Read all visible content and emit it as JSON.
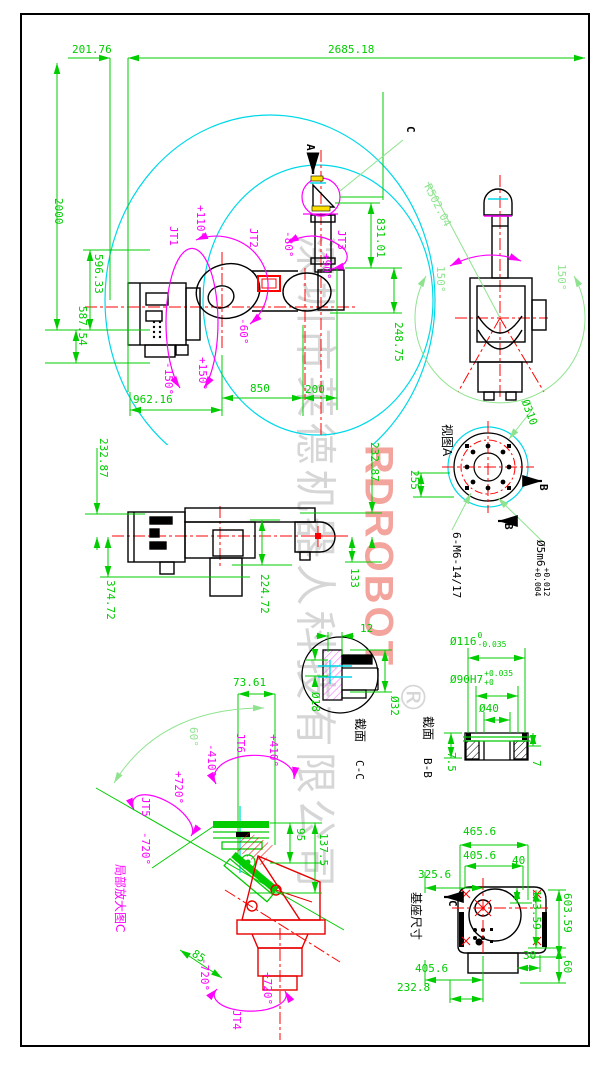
{
  "watermark": {
    "company": "深圳市莱德机器人科技有限公司",
    "brand": "RDROBOT",
    "registered": "®"
  },
  "main_view": {
    "dims": {
      "d201": "201.76",
      "d2685": "2685.18",
      "d2000": "2000",
      "d596": "596.33",
      "d587": "587.54",
      "d962": "962.16",
      "d850": "850",
      "d200": "200",
      "d831": "831.01",
      "d248": "248.75"
    },
    "joints": {
      "jt1": {
        "label": "JT1",
        "min": "-150°",
        "max": "+150°"
      },
      "jt2": {
        "label": "JT2",
        "max": "+110°",
        "min": "-60°"
      },
      "jt3": {
        "label": "JT3",
        "min": "-80°",
        "max": "+90°"
      }
    },
    "view_arrow": "A",
    "detail_mark": "C"
  },
  "top_view": {
    "radius": "R502.04",
    "angle_left": "150°",
    "angle_right": "150°"
  },
  "view_a": {
    "title": "视图A",
    "dia": "Ø310",
    "d255": "255",
    "section_mark": "B",
    "note_bolts": "6-M6-14/17",
    "note_pin": "Ø5m6",
    "pin_tol_top": "+0.012",
    "pin_tol_bot": "+0.004"
  },
  "folded_view": {
    "d232l": "232.87",
    "d232r": "232.87",
    "d374": "374.72",
    "d224": "224.72",
    "d133": "133"
  },
  "section_cc": {
    "title": "截面",
    "name": "C-C",
    "d12": "12",
    "d18": "Ø18",
    "d32": "Ø32"
  },
  "section_bb": {
    "title": "截面",
    "name": "B-B",
    "d116": "Ø116",
    "d116_tol_top": "0",
    "d116_tol_bot": "-0.035",
    "d90": "Ø90H7",
    "d90_tol_top": "+0.035",
    "d90_tol_bot": "+0",
    "d40": "Ø40",
    "d75": "7.5",
    "d7": "7"
  },
  "detail_view": {
    "label": "局部放大图C",
    "d7361": "73.61",
    "d95": "95",
    "d1375": "137.5",
    "d85": "85",
    "d60": "60°",
    "jt4": {
      "label": "JT4",
      "min": "-720°",
      "max": "+720°"
    },
    "jt5": {
      "label": "JT5",
      "min": "-720°",
      "max": "+720°"
    },
    "jt6": {
      "label": "JT6",
      "min": "-410°",
      "max": "+410°"
    }
  },
  "base_view": {
    "title": "基座尺寸",
    "mark": "C",
    "d465": "465.6",
    "d405t": "405.6",
    "d40": "40",
    "d325": "325.6",
    "d143": "143.59",
    "d603": "603.59",
    "d30": "30",
    "d60": "60",
    "d405b": "405.6",
    "d232": "232.8"
  },
  "colors": {
    "dim": "#00cc00",
    "aux": "#8fe38f",
    "center": "#ff0000",
    "joint": "#ff00ff",
    "envelope": "#00d8e8",
    "part": "#000000",
    "detail_part": "#e80000",
    "watermark_gray": "#cccccc",
    "watermark_brand": "#f29b93"
  }
}
